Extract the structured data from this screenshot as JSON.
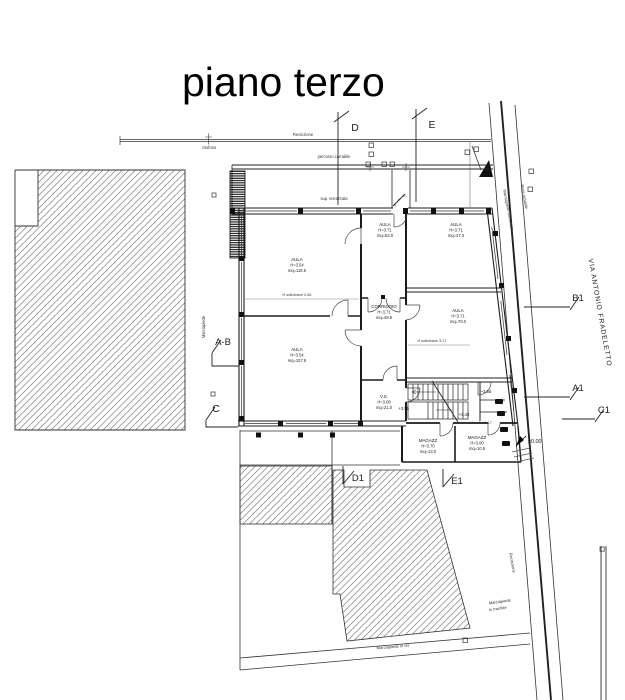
{
  "title": "piano terzo",
  "street_label": "VIA ANTONIO FRADELETTO",
  "site": {
    "recinzione_top": "Recinzione",
    "citofono": "citofono",
    "percorso_carrabile": "percorso carrabile",
    "sup_terrazzata": "sup. terrazzata",
    "marciapiede_left": "Marciapiede",
    "marciapiede_comunale": "Marciapiede comunale",
    "pista_ciclabile": "Pista ciclabile",
    "recinzione_right": "Recinzione",
    "marciapiede_cls": "Marciapiede in cls",
    "marciapiede_trachite_1": "Marciapiede",
    "marciapiede_trachite_2": "in trachite"
  },
  "markers": {
    "d": "D",
    "e": "E",
    "ab": "A-B",
    "c": "C",
    "b1": "B1",
    "a1": "A1",
    "c1": "C1",
    "d1": "D1",
    "e1": "E1"
  },
  "rooms": {
    "aula_nw": {
      "name": "AULA",
      "height": "H=3.54",
      "area": "mq=118.5",
      "beam_note": "H sottotrave 2.84"
    },
    "aula_n1": {
      "name": "AULA",
      "height": "H=3.71",
      "area": "mq=53.0"
    },
    "aula_n2": {
      "name": "AULA",
      "height": "H=3.71",
      "area": "mq=47.3"
    },
    "corridoio": {
      "name": "CORRIDOIO",
      "height": "H=3.71",
      "area": "mq=48.5",
      "beam_note": "H sottotrave 3.17"
    },
    "aula_e": {
      "name": "AULA",
      "height": "H=3.71",
      "area": "mq=70.0"
    },
    "aula_sw": {
      "name": "AULA",
      "height": "H=3.54",
      "area": "mq=107.8"
    },
    "vano_scala": {
      "name": "V.S.",
      "height": "H=3.08",
      "area": "mq=21.0"
    },
    "magazzino_1": {
      "name": "MAGAZZ",
      "height": "H=3.70",
      "area": "mq=13.0"
    },
    "magazzino_2": {
      "name": "MAGAZZ",
      "height": "H=3.00",
      "area": "mq=10.5",
      "beam_note": "H sott.= 3.17"
    }
  },
  "levels": {
    "entry": "±0.00",
    "stair_upper": "+3.55",
    "landing": "+3.55",
    "stair_mid": "+3.43"
  },
  "colors": {
    "line_dark": "#1c1c1c",
    "line_gray": "#555555",
    "paper": "#ffffff"
  }
}
